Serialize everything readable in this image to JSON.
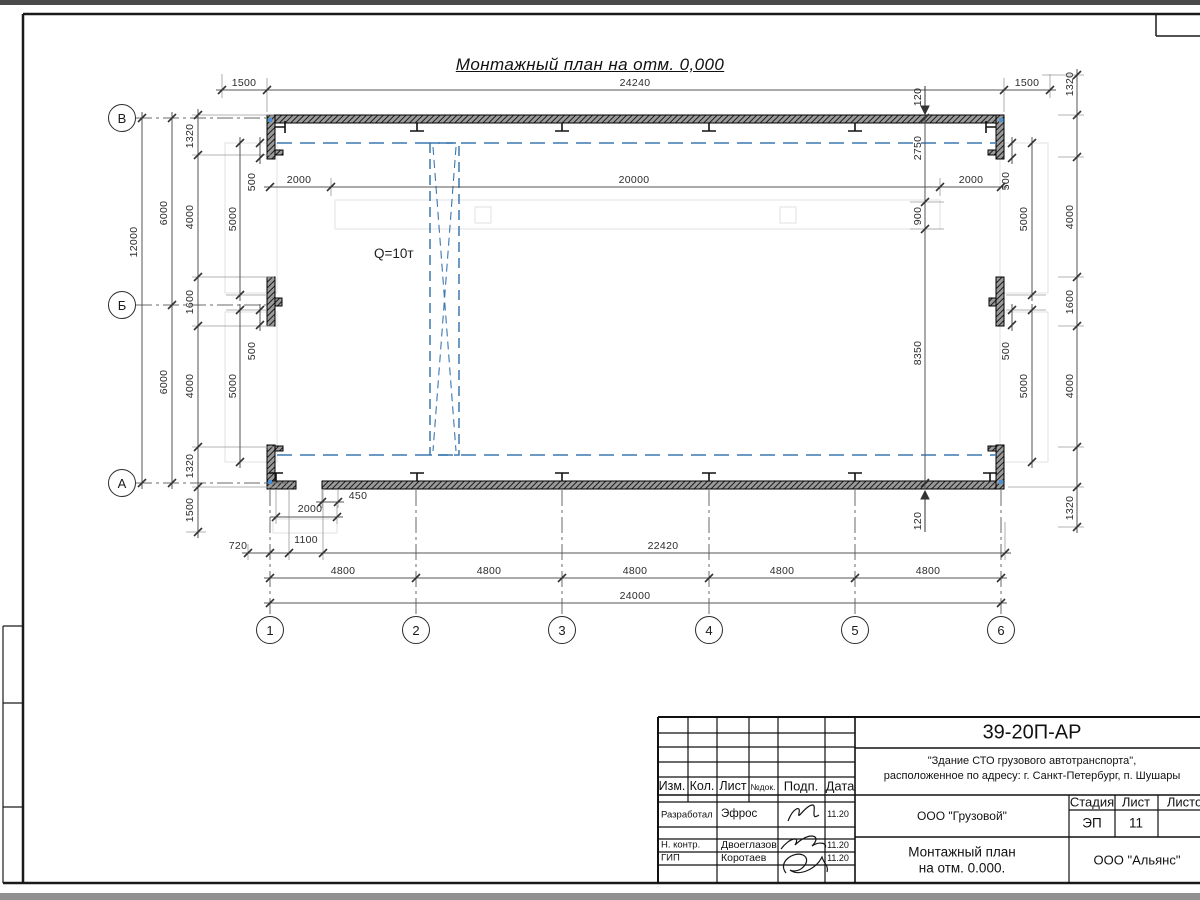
{
  "drawing": {
    "title": "Монтажный план на отм. 0,000",
    "crane_label": "Q=10т",
    "row_axes": [
      "В",
      "Б",
      "А"
    ],
    "col_axes": [
      "1",
      "2",
      "3",
      "4",
      "5",
      "6"
    ],
    "dims": [
      [
        "1500",
        244,
        83,
        0
      ],
      [
        "24240",
        635,
        83,
        0
      ],
      [
        "1500",
        1027,
        83,
        0
      ],
      [
        "2000",
        299,
        180,
        0
      ],
      [
        "20000",
        634,
        180,
        0
      ],
      [
        "2000",
        971,
        180,
        0
      ],
      [
        "12000",
        134,
        242,
        1
      ],
      [
        "6000",
        164,
        213,
        1
      ],
      [
        "6000",
        164,
        382,
        1
      ],
      [
        "1320",
        190,
        136,
        1
      ],
      [
        "4000",
        190,
        217,
        1
      ],
      [
        "1600",
        190,
        302,
        1
      ],
      [
        "4000",
        190,
        386,
        1
      ],
      [
        "1320",
        190,
        466,
        1
      ],
      [
        "1500",
        190,
        510,
        1
      ],
      [
        "5000",
        233,
        219,
        1
      ],
      [
        "5000",
        233,
        386,
        1
      ],
      [
        "500",
        252,
        182,
        1
      ],
      [
        "500",
        252,
        351,
        1
      ],
      [
        "500",
        1006,
        181,
        1
      ],
      [
        "500",
        1006,
        351,
        1
      ],
      [
        "5000",
        1024,
        219,
        1
      ],
      [
        "5000",
        1024,
        386,
        1
      ],
      [
        "120",
        918,
        97,
        1
      ],
      [
        "2750",
        918,
        148,
        1
      ],
      [
        "900",
        918,
        216,
        1
      ],
      [
        "8350",
        918,
        353,
        1
      ],
      [
        "120",
        918,
        521,
        1
      ],
      [
        "1320",
        1070,
        84,
        1
      ],
      [
        "4000",
        1070,
        217,
        1
      ],
      [
        "1600",
        1070,
        302,
        1
      ],
      [
        "4000",
        1070,
        386,
        1
      ],
      [
        "1320",
        1070,
        508,
        1
      ],
      [
        "450",
        358,
        496,
        0
      ],
      [
        "2000",
        310,
        509,
        0
      ],
      [
        "720",
        238,
        546,
        0
      ],
      [
        "1100",
        306,
        540,
        0
      ],
      [
        "22420",
        663,
        546,
        0
      ],
      [
        "4800",
        343,
        571,
        0
      ],
      [
        "4800",
        489,
        571,
        0
      ],
      [
        "4800",
        635,
        571,
        0
      ],
      [
        "4800",
        782,
        571,
        0
      ],
      [
        "4800",
        928,
        571,
        0
      ],
      [
        "24000",
        635,
        596,
        0
      ]
    ]
  },
  "titleblock": {
    "doc_number": "39-20П-АР",
    "object_line1": "\"Здание СТО грузового автотранспорта\",",
    "object_line2": "расположенное по адресу: г. Санкт-Петербург, п. Шушары",
    "client": "ООО \"Грузовой\"",
    "sheet_title_line1": "Монтажный план",
    "sheet_title_line2": "на отм. 0.000.",
    "company": "ООО \"Альянс\"",
    "stage_label": "Стадия",
    "sheet_label": "Лист",
    "sheets_label": "Листов",
    "stage_value": "ЭП",
    "sheet_value": "11",
    "cols": [
      "Изм.",
      "Кол.",
      "Лист",
      "№док.",
      "Подп.",
      "Дата"
    ],
    "rows": [
      {
        "role": "Разработал",
        "name": "Эфрос",
        "date": "11.20"
      },
      {
        "role": "Н. контр.",
        "name": "Двоеглазов",
        "date": "11.20"
      },
      {
        "role": "ГИП",
        "name": "Коротаев",
        "date": "11.20"
      }
    ]
  }
}
